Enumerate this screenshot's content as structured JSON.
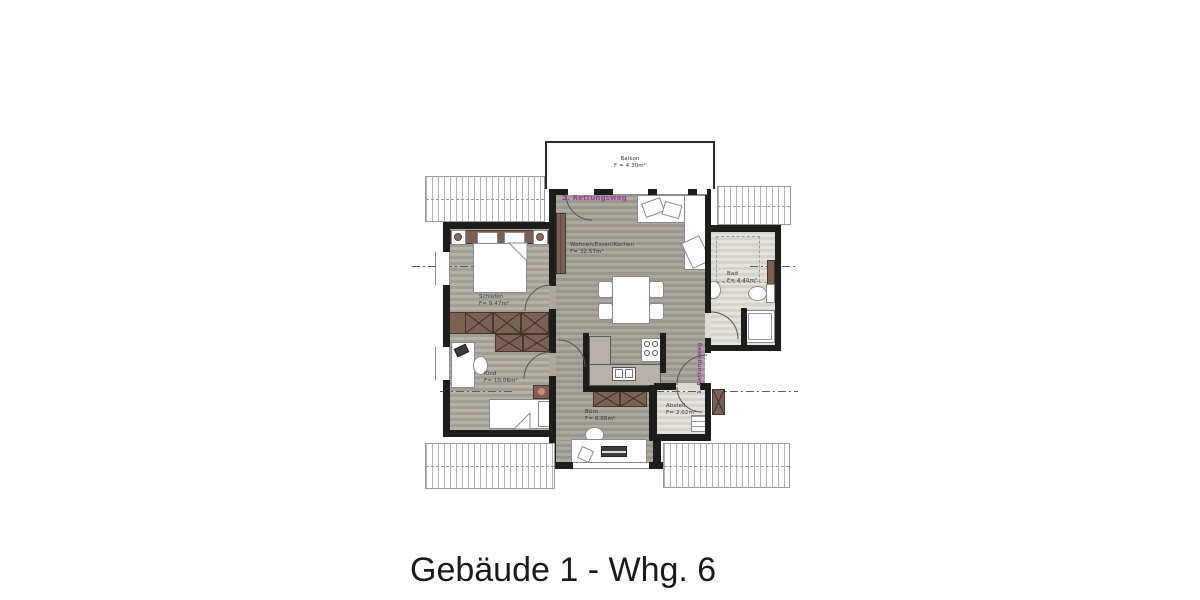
{
  "title": "Gebäude 1 - Whg. 6",
  "plan": {
    "escape_routes": {
      "route1": "1. Rettungsweg",
      "route2": "2. Rettungsweg"
    },
    "rooms": {
      "balkon": {
        "name": "Balkon",
        "area": "F = 4.30m²"
      },
      "wohnen": {
        "name": "Wohnen/Essen/Kochen",
        "area": "F= 32.57m²"
      },
      "schlafen": {
        "name": "Schlafen",
        "area": "F= 9.47m²"
      },
      "kind": {
        "name": "Kind",
        "area": "F= 10.06m²"
      },
      "buero": {
        "name": "Büro",
        "area": "F= 8.88m²"
      },
      "bad": {
        "name": "Bad",
        "area": "F= 4.40m²"
      },
      "abstell": {
        "name": "Abstell.",
        "area": "F= 2.02m²"
      }
    },
    "colors": {
      "wall": "#1d1d1b",
      "wood": "#aca89f",
      "wood-dark": "#a39f97",
      "light-floor": "#dcd9d3",
      "brown": "#7b6054",
      "brown-dark": "#46362c",
      "purple": "#a03da0",
      "line": "#5c5c5c"
    }
  }
}
